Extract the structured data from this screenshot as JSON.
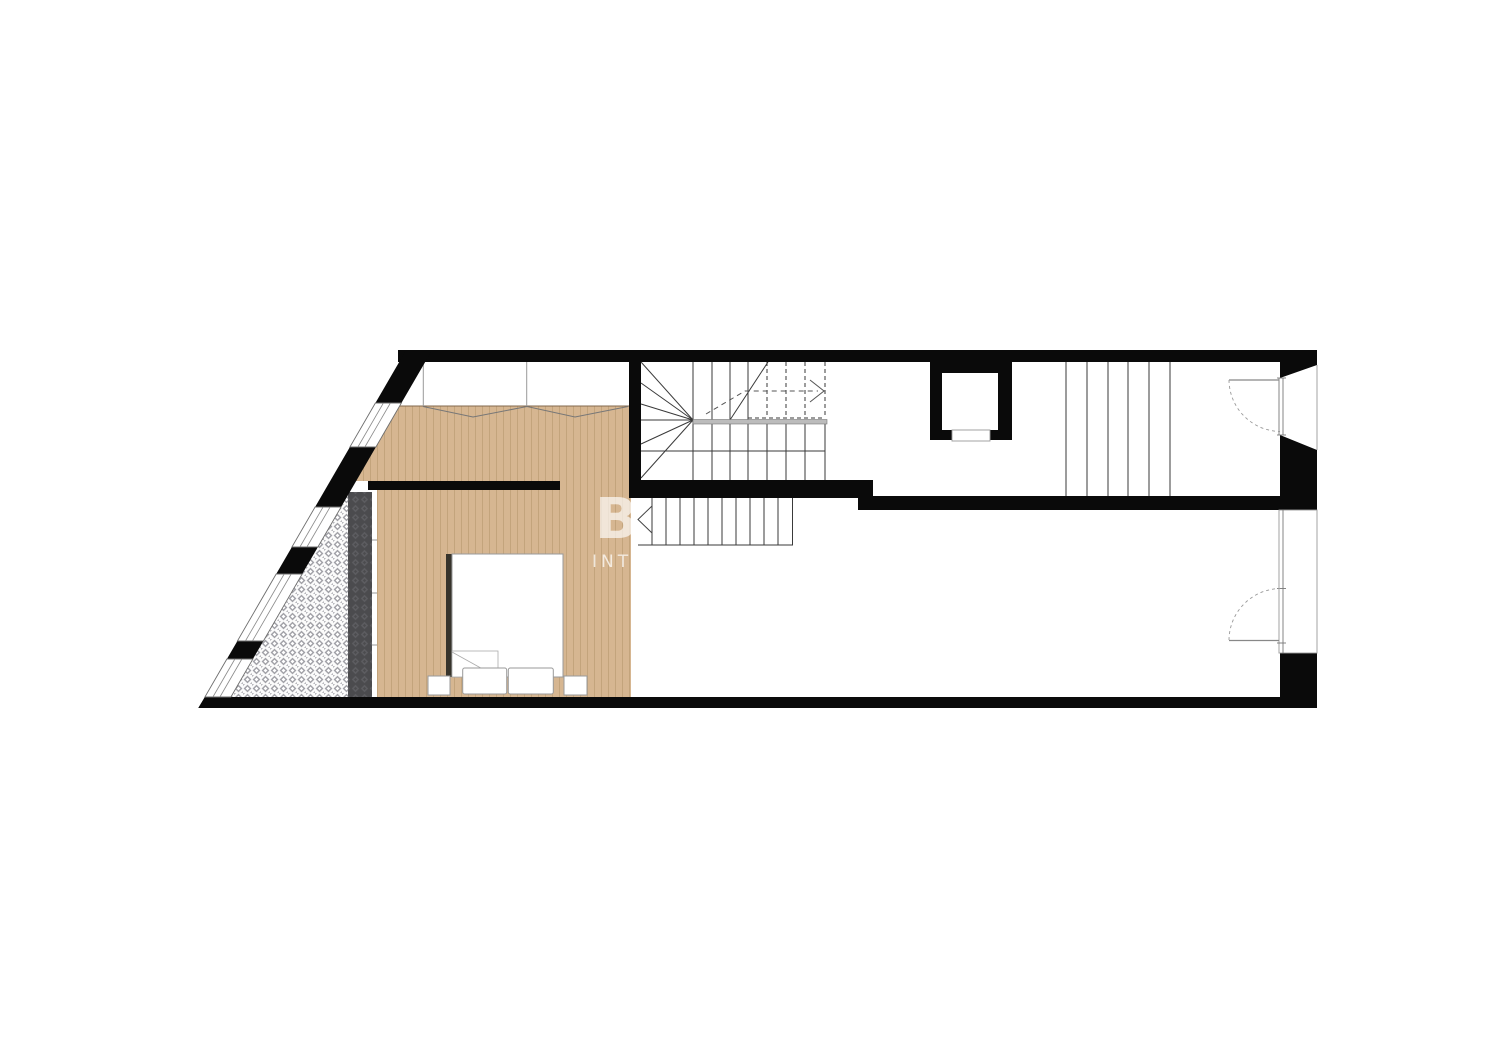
{
  "watermark": {
    "logo": "B",
    "letters": "INTE"
  },
  "colors": {
    "wall": "#0a0a0a",
    "line": "#3a3a3a",
    "thin_line": "#8a8a8a",
    "wood_floor": "#d6b691",
    "wood_grain": "#c3a47c",
    "tile_motif": "#a2a2a8",
    "dark_runner": "#4b4b4e",
    "furniture_stroke": "#9a9a9a",
    "bed_shadow": "#37342c",
    "watermark": "rgba(255,255,255,0.66)"
  }
}
